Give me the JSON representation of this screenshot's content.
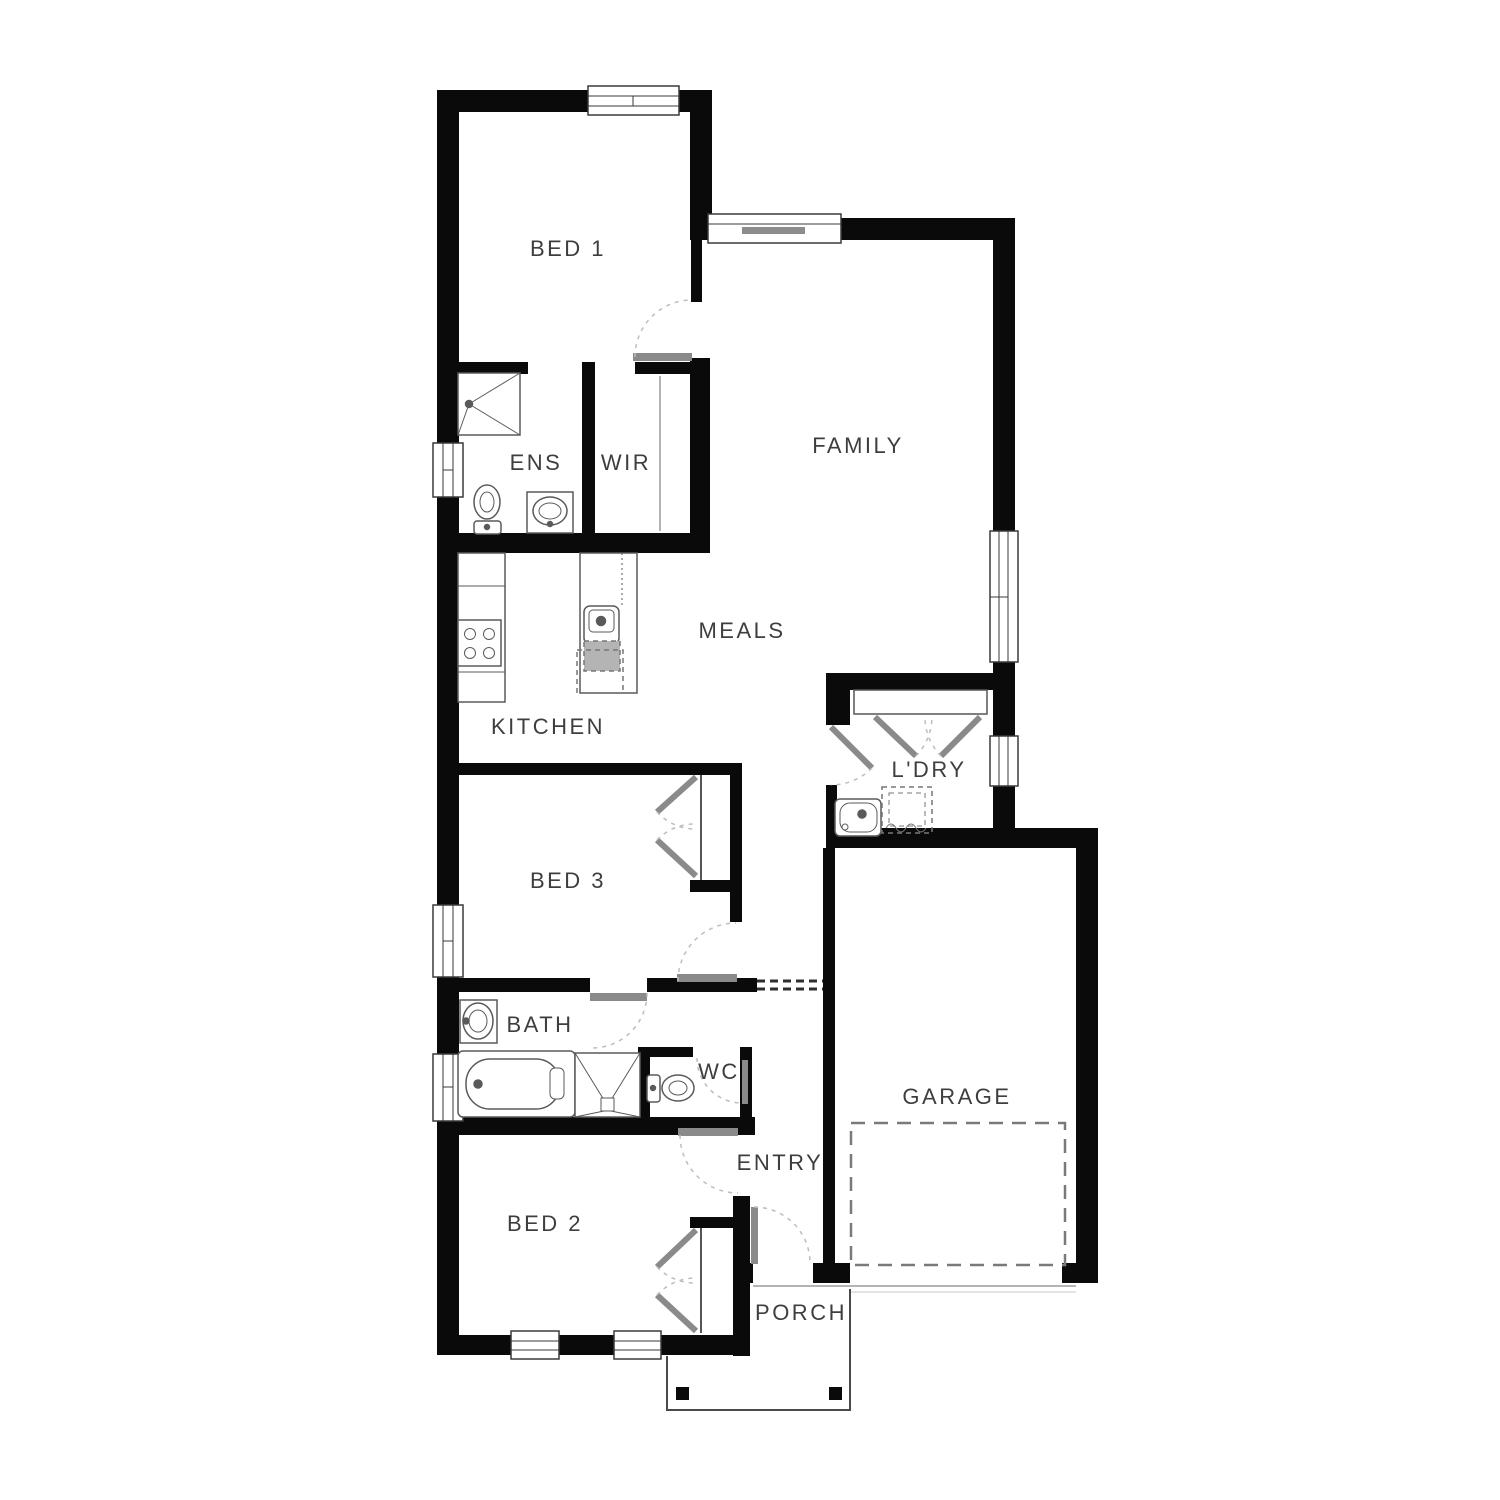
{
  "rooms": [
    {
      "id": "bed1",
      "label": "BED 1"
    },
    {
      "id": "family",
      "label": "FAMILY"
    },
    {
      "id": "ens",
      "label": "ENS"
    },
    {
      "id": "wir",
      "label": "WIR"
    },
    {
      "id": "meals",
      "label": "MEALS"
    },
    {
      "id": "kitchen",
      "label": "KITCHEN"
    },
    {
      "id": "ldry",
      "label": "L'DRY"
    },
    {
      "id": "bed3",
      "label": "BED 3"
    },
    {
      "id": "bath",
      "label": "BATH"
    },
    {
      "id": "wc",
      "label": "WC"
    },
    {
      "id": "garage",
      "label": "GARAGE"
    },
    {
      "id": "entry",
      "label": "ENTRY"
    },
    {
      "id": "bed2",
      "label": "BED 2"
    },
    {
      "id": "porch",
      "label": "PORCH"
    }
  ],
  "colors": {
    "wall": "#0a0a0a",
    "fixture_outline": "#5a5a5a",
    "door_leaf": "#8a8a8a",
    "dash": "#bdbdbd",
    "label_text": "#3e3e3e"
  }
}
